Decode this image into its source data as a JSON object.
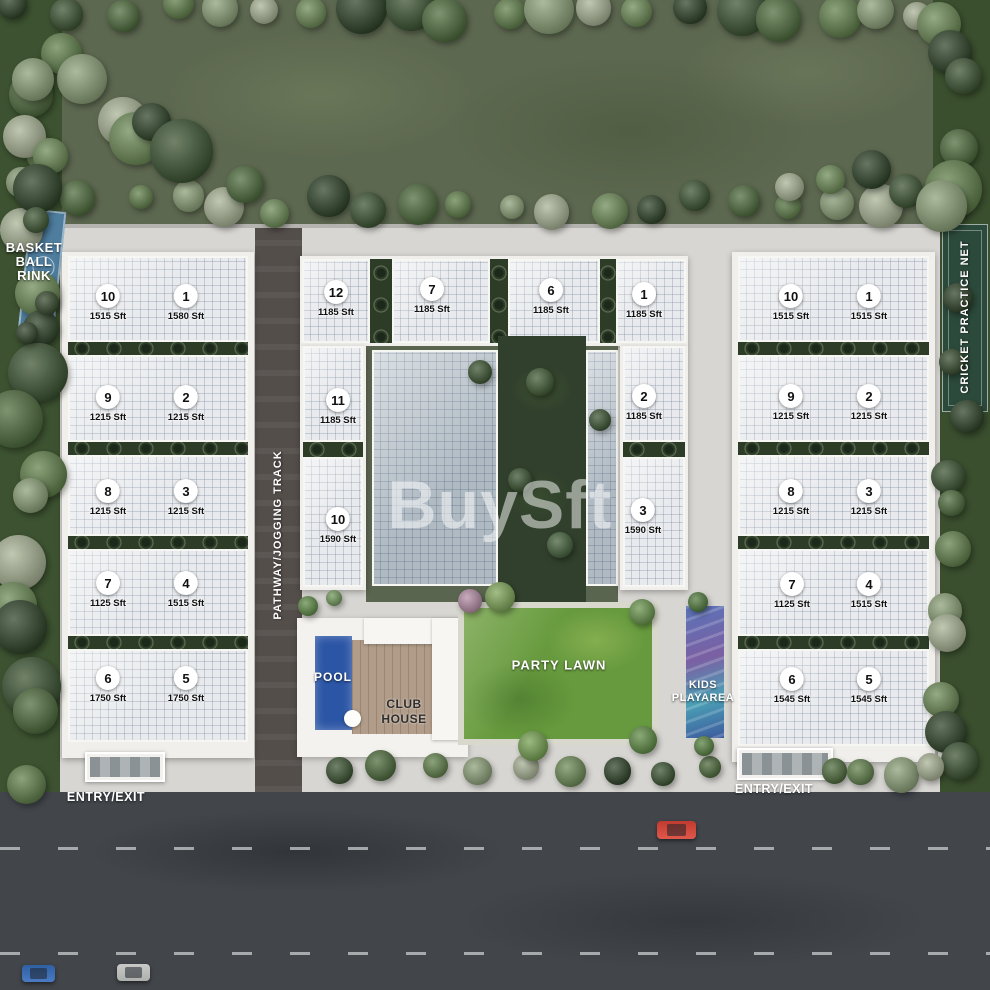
{
  "watermark": "BuySft",
  "amenities": {
    "basketball": {
      "line1": "BASKET",
      "line2": "BALL",
      "line3": "RINK"
    },
    "pathway_label": "PATHWAY/JOGGING TRACK",
    "cricket_label": "CRICKET PRACTICE NET",
    "pool_label": "POOL",
    "clubhouse": {
      "line1": "CLUB",
      "line2": "HOUSE"
    },
    "party_lawn_label": "PARTY LAWN",
    "kids": {
      "line1": "KIDS",
      "line2": "PLAYAREA"
    },
    "entry_left_label": "ENTRY/EXIT",
    "entry_right_label": "ENTRY/EXIT"
  },
  "blocks": {
    "left": {
      "units": [
        {
          "no": "10",
          "area": "1515 Sft"
        },
        {
          "no": "1",
          "area": "1580 Sft"
        },
        {
          "no": "9",
          "area": "1215 Sft"
        },
        {
          "no": "2",
          "area": "1215 Sft"
        },
        {
          "no": "8",
          "area": "1215 Sft"
        },
        {
          "no": "3",
          "area": "1215 Sft"
        },
        {
          "no": "7",
          "area": "1125 Sft"
        },
        {
          "no": "4",
          "area": "1515 Sft"
        },
        {
          "no": "6",
          "area": "1750 Sft"
        },
        {
          "no": "5",
          "area": "1750 Sft"
        }
      ]
    },
    "middle": {
      "units": [
        {
          "no": "12",
          "area": "1185 Sft"
        },
        {
          "no": "7",
          "area": "1185 Sft"
        },
        {
          "no": "6",
          "area": "1185 Sft"
        },
        {
          "no": "1",
          "area": "1185 Sft"
        },
        {
          "no": "11",
          "area": "1185 Sft"
        },
        {
          "no": "2",
          "area": "1185 Sft"
        },
        {
          "no": "10",
          "area": "1590 Sft"
        },
        {
          "no": "3",
          "area": "1590 Sft"
        }
      ]
    },
    "right": {
      "units": [
        {
          "no": "10",
          "area": "1515 Sft"
        },
        {
          "no": "1",
          "area": "1515 Sft"
        },
        {
          "no": "9",
          "area": "1215 Sft"
        },
        {
          "no": "2",
          "area": "1215 Sft"
        },
        {
          "no": "8",
          "area": "1215 Sft"
        },
        {
          "no": "3",
          "area": "1215 Sft"
        },
        {
          "no": "7",
          "area": "1125 Sft"
        },
        {
          "no": "4",
          "area": "1515 Sft"
        },
        {
          "no": "6",
          "area": "1545 Sft"
        },
        {
          "no": "5",
          "area": "1545 Sft"
        }
      ]
    }
  },
  "colors": {
    "pool": "#2b55a5",
    "lawn": "#679a3e",
    "road": "#42464b",
    "court": "#4e7d9e",
    "cricket": "#2c4a3c",
    "roof": "#e8eaed",
    "pavement": "#d7d6d2",
    "field": "#5d6850",
    "hedge": "#2d3c27",
    "watermark_color": "rgba(255,255,255,0.5)"
  }
}
